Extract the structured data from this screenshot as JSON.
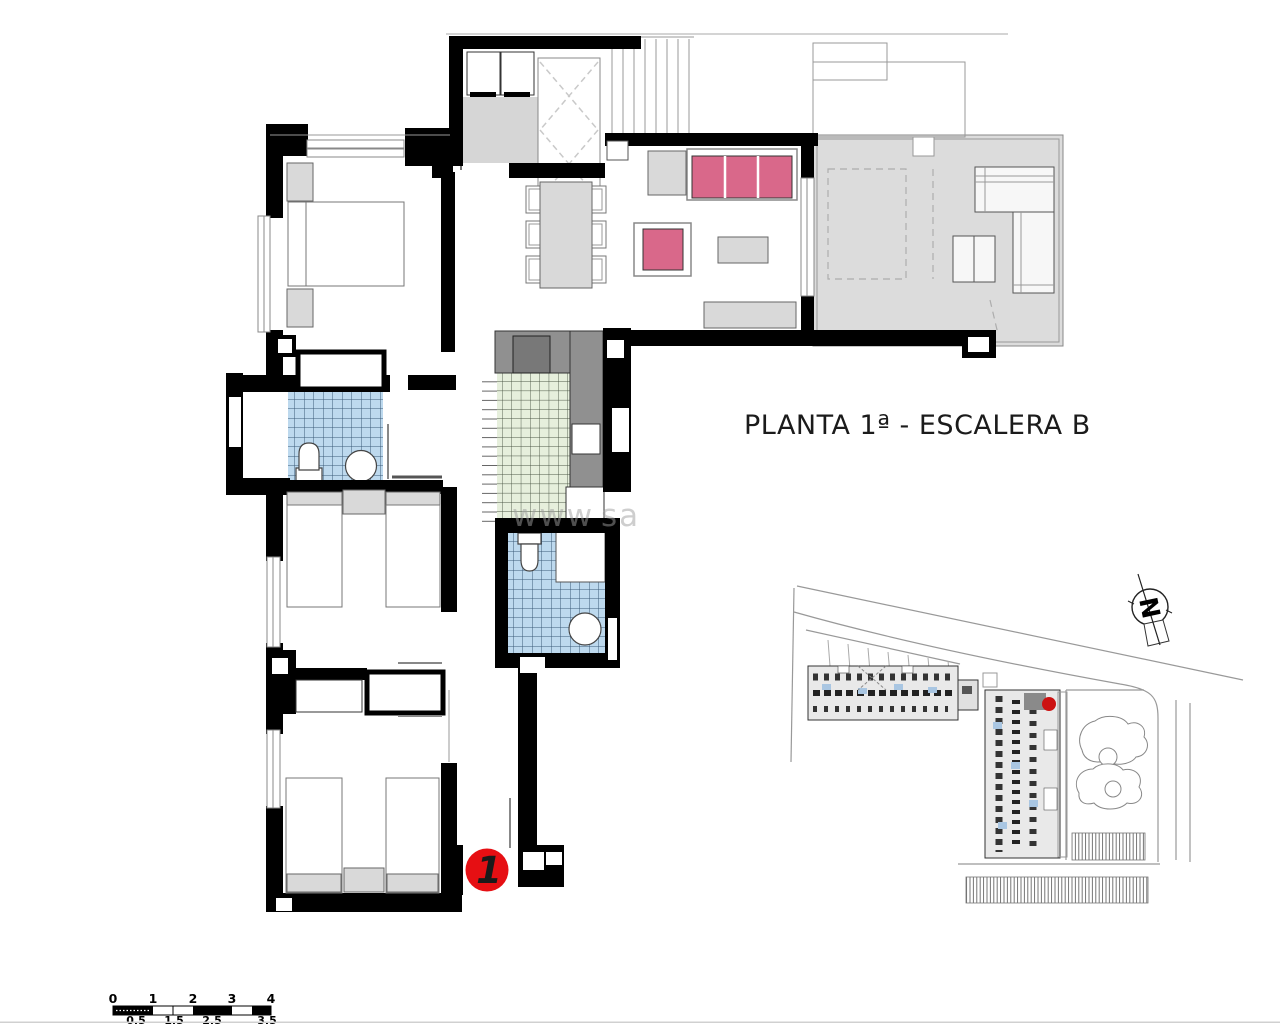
{
  "title": "PLANTA 1ª - ESCALERA B",
  "unit_marker": {
    "label": "1"
  },
  "watermark": {
    "part1": "www",
    "part2": "sa"
  },
  "north_arrow": {
    "label": "N"
  },
  "scale_bar": {
    "top_labels": [
      "0",
      "1",
      "2",
      "3",
      "4"
    ],
    "bottom_labels": [
      "0.5",
      "1.5",
      "2.5",
      "3.5"
    ]
  },
  "colors": {
    "marker_red": "#e60f13",
    "site_dot_red": "#cc1111",
    "sofa_pink": "#d9688a",
    "tile_blue": "#bdd9ee",
    "tile_green": "#e6efdc",
    "terrace_gray": "#dcdcdc",
    "counter_gray": "#909090",
    "furniture_gray": "#d9d9d9",
    "wall_black": "#000000"
  }
}
